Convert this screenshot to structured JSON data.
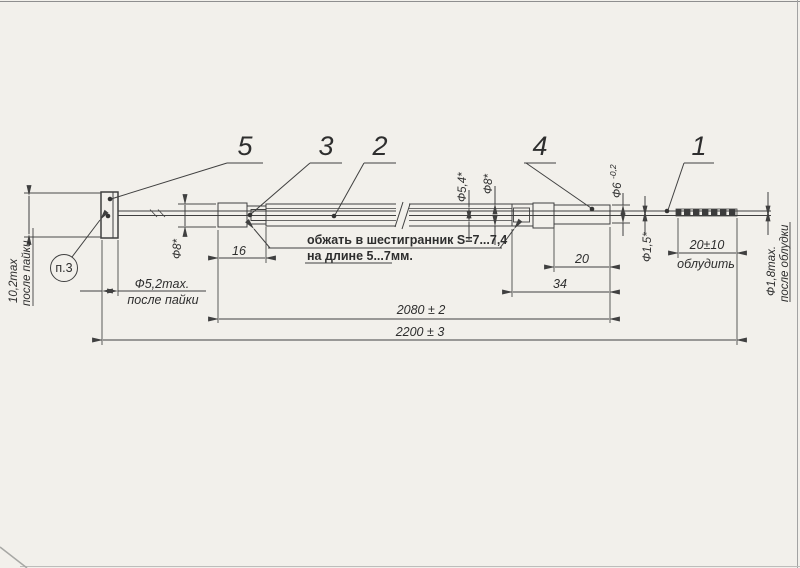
{
  "colors": {
    "ink": "#404040",
    "paper": "#f2f0eb"
  },
  "callout": {
    "label": "п.3"
  },
  "part_labels": {
    "n1": "1",
    "n2": "2",
    "n3": "3",
    "n4": "4",
    "n5": "5"
  },
  "note": {
    "line1": "обжать в шестигранник S=7...7,4",
    "line2": "на длине 5...7мм."
  },
  "dims": {
    "solder_height_1": "10,2max",
    "solder_height_2": "после пайки",
    "solder_dia_1": "Ф5,2max.",
    "solder_dia_2": "после пайки",
    "left_fitting_len": "16",
    "left_fitting_dia": "Ф8*",
    "tube_inner_dia": "Ф5,4*",
    "tube_outer_dia": "Ф8*",
    "right_dia_base": "Ф6",
    "right_dia_tol": "-0,2",
    "right_cyl_len": "20",
    "right_fitting_len": "34",
    "wire_dia": "Ф1,5*",
    "tin_len_1": "20±10",
    "tin_len_2": "облудить",
    "tin_dia_1": "Ф1,8max.",
    "tin_dia_2": "после облудки",
    "len_2080": "2080 ± 2",
    "len_2200": "2200 ± 3"
  }
}
